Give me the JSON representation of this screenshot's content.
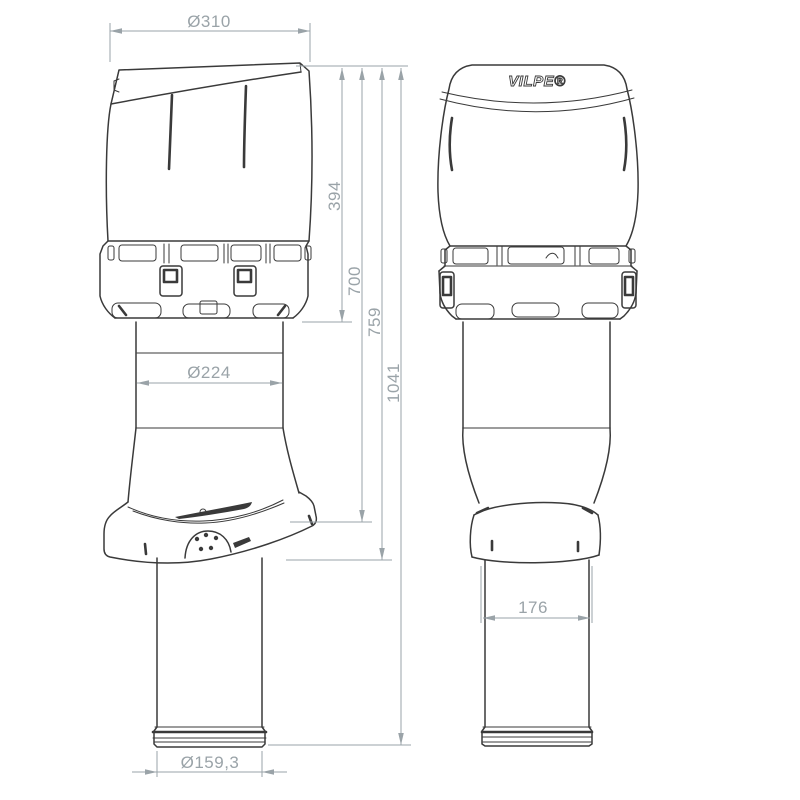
{
  "logo": {
    "brand": "VILPE®"
  },
  "dimensions": {
    "hood_diameter": "Ø310",
    "hood_height": "394",
    "height_to_flashing_top": "700",
    "height_to_flashing_bottom": "759",
    "total_height": "1041",
    "upper_pipe_diameter": "Ø224",
    "lower_pipe_width": "176",
    "outlet_diameter": "Ø159,3"
  },
  "colors": {
    "background": "#ffffff",
    "outline": "#3a3a3a",
    "dimension": "#9aa3a8"
  }
}
